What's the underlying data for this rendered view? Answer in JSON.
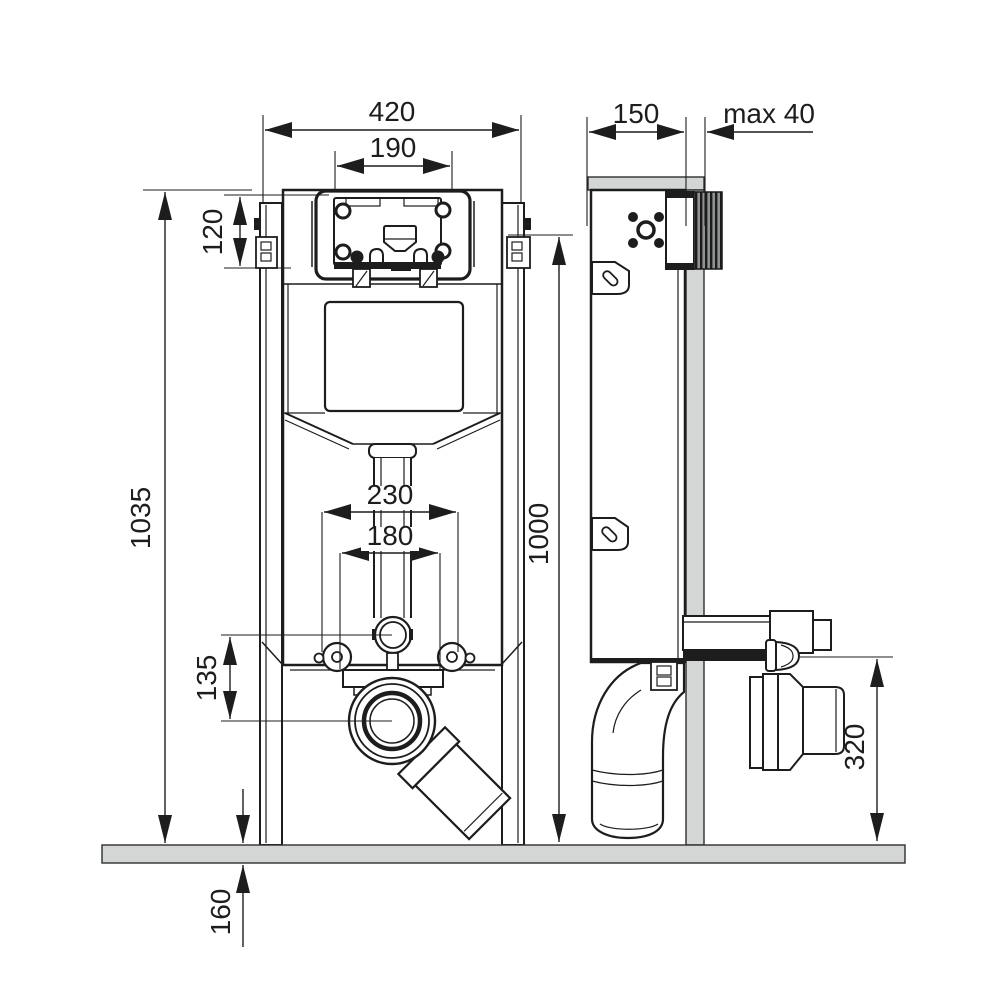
{
  "drawing": {
    "description": "Technical installation diagram of a concealed WC cistern frame shown in front and side elevation with dimension lines (millimetres)",
    "views": {
      "front": "front elevation",
      "side": "side elevation"
    },
    "labels": {
      "frame_width": "420",
      "flush_plate_width": "190",
      "head_unit_height": "120",
      "total_height": "1035",
      "anchor_span": "230",
      "bracket_span": "180",
      "outlet_offset": "135",
      "floor_buildup": "160",
      "install_height": "1000",
      "frame_depth": "150",
      "max_wall_cover": "max 40",
      "outlet_height": "320"
    },
    "colors": {
      "line": "#1d1d1d",
      "wall_fill": "#d3d6d5",
      "floor_fill": "#d3d6d5",
      "hatch_dark": "#1c1c1c",
      "background": "#ffffff"
    }
  }
}
